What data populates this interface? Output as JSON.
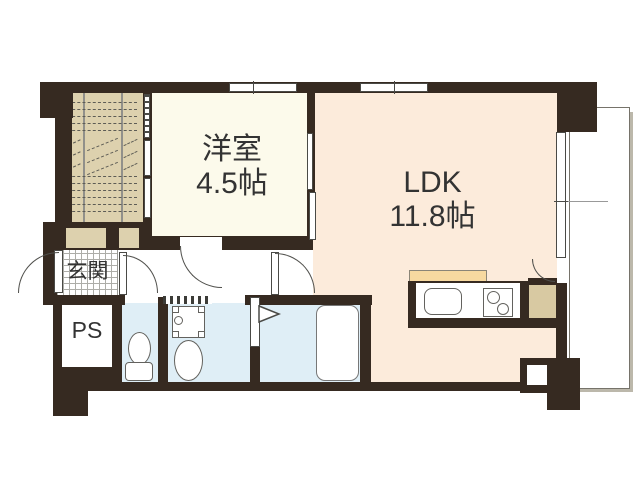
{
  "plan": {
    "title": "apartment-floor-plan",
    "rooms": {
      "yoshitsu": {
        "name": "洋室",
        "size": "4.5帖"
      },
      "ldk": {
        "name": "LDK",
        "size": "11.8帖"
      },
      "genkan": {
        "name": "玄関"
      },
      "ps": {
        "name": "PS"
      }
    },
    "colors": {
      "wall": "#362a21",
      "western_room_floor": "#fcfaeb",
      "ldk_floor": "#fcebdb",
      "wet_area_floor": "#dfeef6",
      "stair_tan": "#ddd1ae",
      "kitchen_backsplash": "#f7d9a0",
      "line": "#4f4f4b"
    },
    "fixtures": [
      "staircase",
      "shoe-cabinet",
      "entrance-door",
      "toilet",
      "washing-machine-pan",
      "wash-basin",
      "bathtub",
      "kitchen-sink",
      "stove",
      "refrigerator-space",
      "balcony"
    ]
  }
}
